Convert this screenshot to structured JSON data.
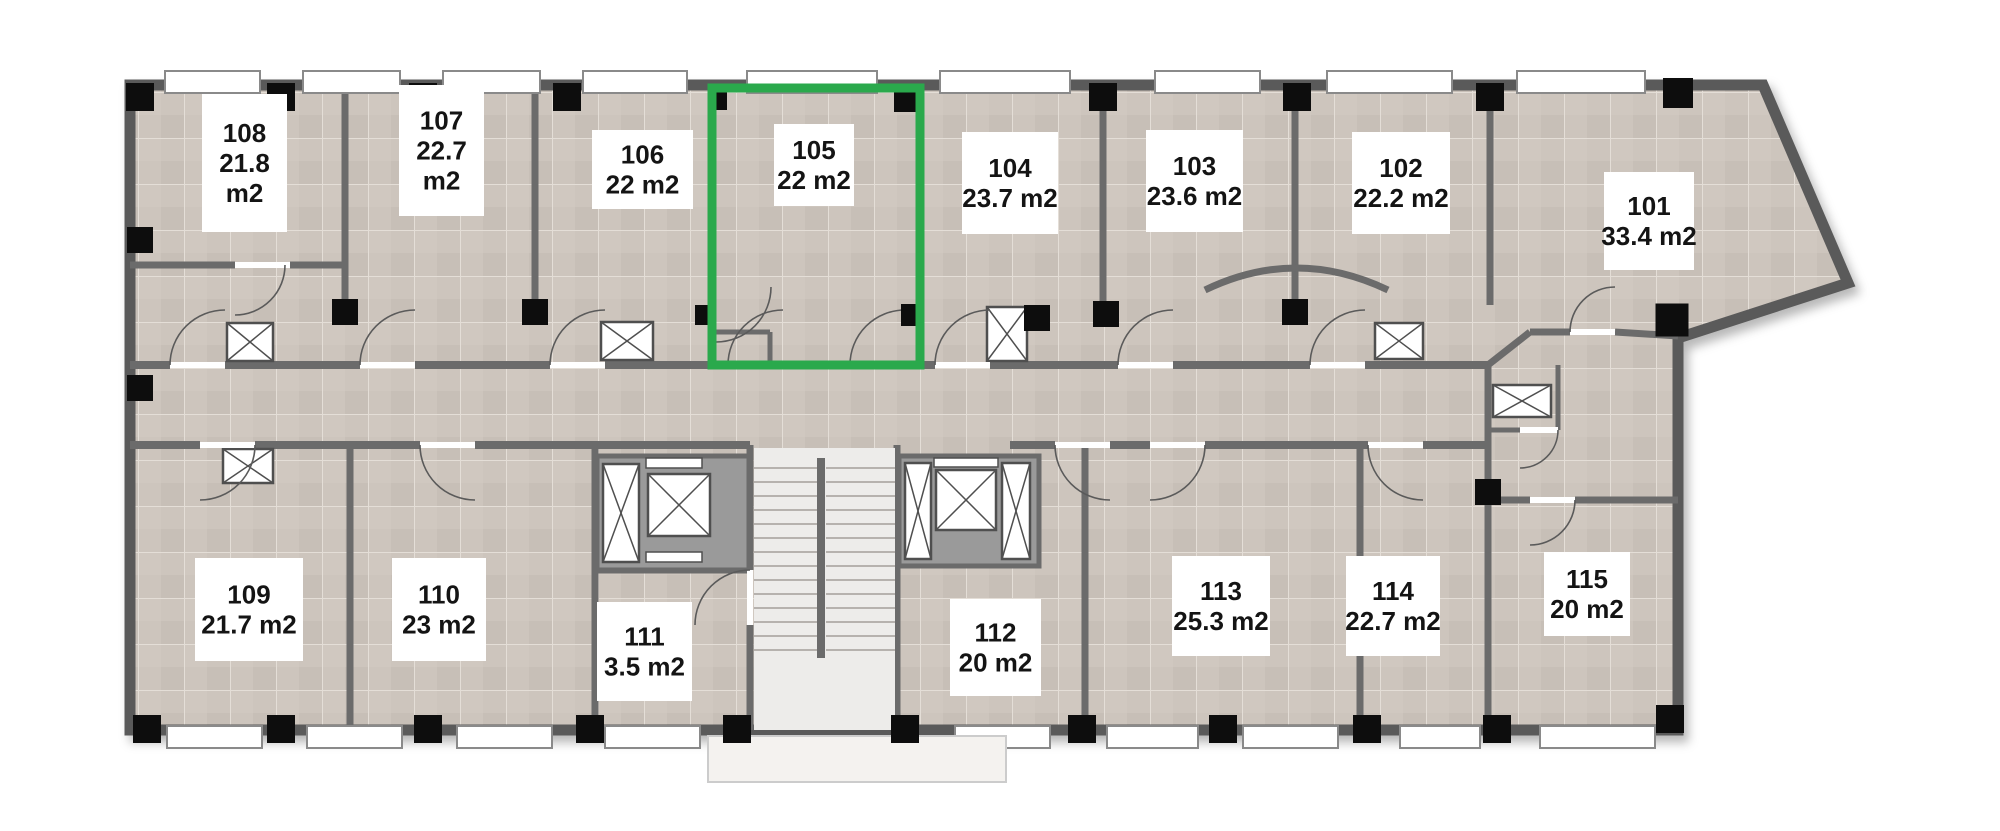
{
  "plan": {
    "canvas": {
      "w": 2000,
      "h": 831
    },
    "colors": {
      "floor": "#cdc5bd",
      "tile_line": "#e4ded7",
      "wall": "#6b6b6b",
      "wall_dark": "#5a5a5a",
      "column": "#0d0d0d",
      "window_fill": "#ffffff",
      "window_frame": "#8a8a8a",
      "stair_floor": "#edecea",
      "stair_tread": "#a49f99",
      "porch": "#f4f2ef",
      "highlight": "#2aa94c",
      "card": "#ffffff",
      "elevator_block": "#9a9a9a",
      "shaft_stroke": "#4f4f4f"
    },
    "outline": [
      [
        130,
        85
      ],
      [
        1763,
        85
      ],
      [
        1848,
        283
      ],
      [
        1678,
        338
      ],
      [
        1678,
        730
      ],
      [
        130,
        730
      ]
    ],
    "walls": [
      [
        345,
        90,
        345,
        305,
        7
      ],
      [
        535,
        90,
        535,
        305,
        7
      ],
      [
        713,
        90,
        713,
        307,
        7
      ],
      [
        920,
        90,
        920,
        307,
        7
      ],
      [
        1103,
        90,
        1103,
        305,
        7
      ],
      [
        1295,
        90,
        1295,
        305,
        7
      ],
      [
        1490,
        90,
        1490,
        305,
        7
      ],
      [
        130,
        265,
        235,
        265,
        7
      ],
      [
        290,
        265,
        345,
        265,
        7
      ],
      [
        130,
        365,
        170,
        365,
        8
      ],
      [
        225,
        365,
        360,
        365,
        8
      ],
      [
        415,
        365,
        550,
        365,
        8
      ],
      [
        605,
        365,
        728,
        365,
        8
      ],
      [
        783,
        365,
        850,
        365,
        8
      ],
      [
        905,
        365,
        935,
        365,
        8
      ],
      [
        990,
        365,
        1118,
        365,
        8
      ],
      [
        1173,
        365,
        1310,
        365,
        8
      ],
      [
        1365,
        365,
        1488,
        365,
        8
      ],
      [
        1488,
        365,
        1530,
        332,
        7
      ],
      [
        1530,
        332,
        1570,
        332,
        7
      ],
      [
        1615,
        332,
        1678,
        336,
        7
      ],
      [
        1488,
        365,
        1488,
        730,
        7
      ],
      [
        1558,
        365,
        1558,
        430,
        5
      ],
      [
        1488,
        430,
        1520,
        430,
        5
      ],
      [
        1488,
        500,
        1530,
        500,
        7
      ],
      [
        1575,
        500,
        1678,
        500,
        7
      ],
      [
        130,
        445,
        200,
        445,
        8
      ],
      [
        255,
        445,
        420,
        445,
        8
      ],
      [
        475,
        445,
        750,
        445,
        8
      ],
      [
        1010,
        445,
        1055,
        445,
        8
      ],
      [
        1110,
        445,
        1150,
        445,
        8
      ],
      [
        1205,
        445,
        1368,
        445,
        8
      ],
      [
        1423,
        445,
        1488,
        445,
        8
      ],
      [
        350,
        445,
        350,
        730,
        7
      ],
      [
        595,
        445,
        595,
        730,
        7
      ],
      [
        750,
        445,
        750,
        570,
        7
      ],
      [
        750,
        625,
        750,
        730,
        7
      ],
      [
        897,
        445,
        897,
        730,
        7
      ],
      [
        1085,
        445,
        1085,
        730,
        7
      ],
      [
        1360,
        445,
        1360,
        730,
        7
      ],
      [
        595,
        570,
        750,
        570,
        7
      ],
      [
        713,
        332,
        770,
        332,
        5
      ],
      [
        770,
        332,
        770,
        365,
        5
      ]
    ],
    "curved_walls": [
      {
        "name": "room-103-curved-wall",
        "d": "M 1205 290 Q 1296 246 1388 290",
        "w": 7
      }
    ],
    "windows": {
      "top": [
        [
          165,
          260
        ],
        [
          303,
          400
        ],
        [
          443,
          540
        ],
        [
          583,
          687
        ],
        [
          747,
          877
        ],
        [
          940,
          1070
        ],
        [
          1155,
          1260
        ],
        [
          1327,
          1452
        ],
        [
          1517,
          1645
        ]
      ],
      "bottom": [
        [
          167,
          262
        ],
        [
          307,
          402
        ],
        [
          457,
          552
        ],
        [
          605,
          700
        ],
        [
          955,
          1050
        ],
        [
          1107,
          1198
        ],
        [
          1243,
          1338
        ],
        [
          1400,
          1480
        ],
        [
          1540,
          1655
        ]
      ],
      "y_top": 71,
      "h_top": 22,
      "y_bottom": 726,
      "h_bottom": 22
    },
    "columns": {
      "top": [
        [
          140,
          97,
          28
        ],
        [
          281,
          97,
          28
        ],
        [
          423,
          97,
          28
        ],
        [
          567,
          97,
          28
        ],
        [
          718,
          101,
          18
        ],
        [
          905,
          101,
          22
        ],
        [
          1103,
          97,
          28
        ],
        [
          1297,
          97,
          28
        ],
        [
          1490,
          97,
          28
        ],
        [
          1678,
          93,
          30
        ]
      ],
      "middle": [
        [
          140,
          240,
          26
        ],
        [
          140,
          388,
          26
        ],
        [
          345,
          312,
          26
        ],
        [
          535,
          312,
          26
        ],
        [
          705,
          315,
          20
        ],
        [
          912,
          315,
          22
        ],
        [
          1037,
          318,
          26
        ],
        [
          1106,
          314,
          26
        ],
        [
          1295,
          312,
          26
        ],
        [
          1672,
          320,
          33
        ],
        [
          1488,
          492,
          26
        ]
      ],
      "bottom": [
        [
          147,
          729,
          28
        ],
        [
          281,
          729,
          28
        ],
        [
          428,
          729,
          28
        ],
        [
          590,
          729,
          28
        ],
        [
          737,
          729,
          28
        ],
        [
          905,
          729,
          28
        ],
        [
          1082,
          729,
          28
        ],
        [
          1223,
          729,
          28
        ],
        [
          1367,
          729,
          28
        ],
        [
          1497,
          729,
          28
        ],
        [
          1670,
          719,
          28
        ]
      ]
    },
    "shafts": [
      [
        227,
        323,
        46,
        38
      ],
      [
        601,
        322,
        52,
        38
      ],
      [
        987,
        307,
        40,
        54
      ],
      [
        1375,
        323,
        48,
        36
      ],
      [
        1493,
        385,
        58,
        32
      ],
      [
        223,
        449,
        50,
        34
      ]
    ],
    "elevators": {
      "left": {
        "block": [
          597,
          456,
          152,
          114
        ],
        "cars": [
          [
            603,
            464,
            36,
            98
          ],
          [
            648,
            474,
            62,
            62
          ]
        ],
        "slots": [
          [
            646,
            458,
            56,
            10
          ],
          [
            646,
            552,
            56,
            10
          ]
        ]
      },
      "right": {
        "block": [
          899,
          456,
          140,
          110
        ],
        "cars": [
          [
            905,
            463,
            26,
            96
          ],
          [
            936,
            470,
            60,
            60
          ],
          [
            1002,
            463,
            28,
            96
          ]
        ],
        "slots": [
          [
            934,
            458,
            64,
            9
          ]
        ]
      }
    },
    "stairs": {
      "area": [
        754,
        448,
        141,
        282
      ],
      "flights": [
        [
          754,
          817
        ],
        [
          826,
          895
        ]
      ],
      "tread_y": [
        468,
        650,
        14
      ],
      "divider": [
        817,
        458,
        8,
        200
      ]
    },
    "porch": [
      708,
      736,
      298,
      46
    ],
    "doors": [
      {
        "hinge": [
          225,
          365
        ],
        "r": 55,
        "q": "nw",
        "leaf": [
          170,
          365,
          225,
          365
        ]
      },
      {
        "hinge": [
          415,
          365
        ],
        "r": 55,
        "q": "nw",
        "leaf": [
          360,
          365,
          415,
          365
        ]
      },
      {
        "hinge": [
          605,
          365
        ],
        "r": 55,
        "q": "nw",
        "leaf": [
          550,
          365,
          605,
          365
        ]
      },
      {
        "hinge": [
          783,
          365
        ],
        "r": 55,
        "q": "nw",
        "leaf": [
          728,
          365,
          783,
          365
        ]
      },
      {
        "hinge": [
          905,
          365
        ],
        "r": 55,
        "q": "nw",
        "leaf": [
          850,
          365,
          905,
          365
        ]
      },
      {
        "hinge": [
          990,
          365
        ],
        "r": 55,
        "q": "nw",
        "leaf": [
          935,
          365,
          990,
          365
        ]
      },
      {
        "hinge": [
          1173,
          365
        ],
        "r": 55,
        "q": "nw",
        "leaf": [
          1118,
          365,
          1173,
          365
        ]
      },
      {
        "hinge": [
          1365,
          365
        ],
        "r": 55,
        "q": "nw",
        "leaf": [
          1310,
          365,
          1365,
          365
        ]
      },
      {
        "hinge": [
          1615,
          332
        ],
        "r": 45,
        "q": "nw",
        "leaf": [
          1570,
          332,
          1615,
          332
        ]
      },
      {
        "hinge": [
          200,
          445
        ],
        "r": 55,
        "q": "se",
        "leaf": [
          200,
          445,
          255,
          445
        ]
      },
      {
        "hinge": [
          475,
          445
        ],
        "r": 55,
        "q": "sw",
        "leaf": [
          420,
          445,
          475,
          445
        ]
      },
      {
        "hinge": [
          1110,
          445
        ],
        "r": 55,
        "q": "sw",
        "leaf": [
          1055,
          445,
          1110,
          445
        ]
      },
      {
        "hinge": [
          1150,
          445
        ],
        "r": 55,
        "q": "se",
        "leaf": [
          1150,
          445,
          1205,
          445
        ]
      },
      {
        "hinge": [
          1423,
          445
        ],
        "r": 55,
        "q": "sw",
        "leaf": [
          1368,
          445,
          1423,
          445
        ]
      },
      {
        "hinge": [
          750,
          625
        ],
        "r": 55,
        "q": "nw",
        "leaf": [
          750,
          570,
          750,
          625
        ]
      },
      {
        "hinge": [
          1530,
          500
        ],
        "r": 45,
        "q": "se",
        "leaf": [
          1530,
          500,
          1575,
          500
        ]
      },
      {
        "hinge": [
          1520,
          430
        ],
        "r": 38,
        "q": "se",
        "leaf": [
          1520,
          430,
          1558,
          430
        ]
      },
      {
        "hinge": [
          716,
          287
        ],
        "r": 55,
        "q": "se",
        "leaf": null
      },
      {
        "hinge": [
          235,
          265
        ],
        "r": 50,
        "q": "se",
        "leaf": [
          235,
          265,
          290,
          265
        ]
      }
    ],
    "rooms": [
      {
        "number": "101",
        "area": "33.4",
        "unit": "m2",
        "lines": [
          "101",
          "33.4 m2"
        ],
        "card": [
          1604,
          172,
          90,
          98
        ],
        "bounds": [
          1494,
          90,
          300,
          244
        ]
      },
      {
        "number": "102",
        "area": "22.2",
        "unit": "m2",
        "lines": [
          "102",
          "22.2 m2"
        ],
        "card": [
          1352,
          132,
          98,
          102
        ],
        "bounds": [
          1299,
          90,
          187,
          271
        ]
      },
      {
        "number": "103",
        "area": "23.6",
        "unit": "m2",
        "lines": [
          "103",
          "23.6 m2"
        ],
        "card": [
          1146,
          130,
          97,
          102
        ],
        "bounds": [
          1107,
          90,
          184,
          271
        ]
      },
      {
        "number": "104",
        "area": "23.7",
        "unit": "m2",
        "lines": [
          "104",
          "23.7 m2"
        ],
        "card": [
          962,
          132,
          96,
          102
        ],
        "bounds": [
          924,
          90,
          179,
          271
        ]
      },
      {
        "number": "105",
        "area": "22",
        "unit": "m2",
        "lines": [
          "105",
          "22 m2"
        ],
        "card": [
          774,
          124,
          80,
          82
        ],
        "bounds": [
          717,
          92,
          199,
          269
        ]
      },
      {
        "number": "106",
        "area": "22",
        "unit": "m2",
        "lines": [
          "106",
          "22 m2"
        ],
        "card": [
          592,
          130,
          101,
          79
        ],
        "bounds": [
          539,
          90,
          170,
          271
        ]
      },
      {
        "number": "107",
        "area": "22.7",
        "unit": "m2",
        "lines": [
          "107",
          "22.7",
          "m2"
        ],
        "card": [
          399,
          85,
          85,
          131
        ],
        "bounds": [
          349,
          90,
          182,
          271
        ]
      },
      {
        "number": "108",
        "area": "21.8",
        "unit": "m2",
        "lines": [
          "108",
          "21.8",
          "m2"
        ],
        "card": [
          202,
          94,
          85,
          138
        ],
        "bounds": [
          134,
          90,
          207,
          171
        ]
      },
      {
        "number": "109",
        "area": "21.7",
        "unit": "m2",
        "lines": [
          "109",
          "21.7 m2"
        ],
        "card": [
          195,
          558,
          108,
          103
        ],
        "bounds": [
          134,
          449,
          212,
          277
        ]
      },
      {
        "number": "110",
        "area": "23",
        "unit": "m2",
        "lines": [
          "110",
          "23 m2"
        ],
        "card": [
          392,
          558,
          94,
          103
        ],
        "bounds": [
          354,
          449,
          237,
          277
        ]
      },
      {
        "number": "111",
        "area": "3.5",
        "unit": "m2",
        "lines": [
          "111",
          "3.5 m2"
        ],
        "card": [
          597,
          602,
          95,
          99
        ],
        "bounds": [
          599,
          574,
          147,
          152
        ]
      },
      {
        "number": "112",
        "area": "20",
        "unit": "m2",
        "lines": [
          "112",
          "20 m2"
        ],
        "card": [
          950,
          599,
          91,
          97
        ],
        "bounds": [
          901,
          569,
          180,
          157
        ]
      },
      {
        "number": "113",
        "area": "25.3",
        "unit": "m2",
        "lines": [
          "113",
          "25.3 m2"
        ],
        "card": [
          1172,
          556,
          98,
          100
        ],
        "bounds": [
          1089,
          449,
          267,
          277
        ]
      },
      {
        "number": "114",
        "area": "22.7",
        "unit": "m2",
        "lines": [
          "114",
          "22.7 m2"
        ],
        "card": [
          1346,
          556,
          94,
          100
        ],
        "bounds": [
          1364,
          449,
          120,
          277
        ]
      },
      {
        "number": "115",
        "area": "20",
        "unit": "m2",
        "lines": [
          "115",
          "20 m2"
        ],
        "card": [
          1544,
          552,
          86,
          84
        ],
        "bounds": [
          1492,
          504,
          182,
          222
        ]
      }
    ],
    "highlight": {
      "room": "105",
      "rect": [
        712,
        88,
        208,
        277
      ],
      "color": "#2aa94c",
      "width": 9
    }
  }
}
